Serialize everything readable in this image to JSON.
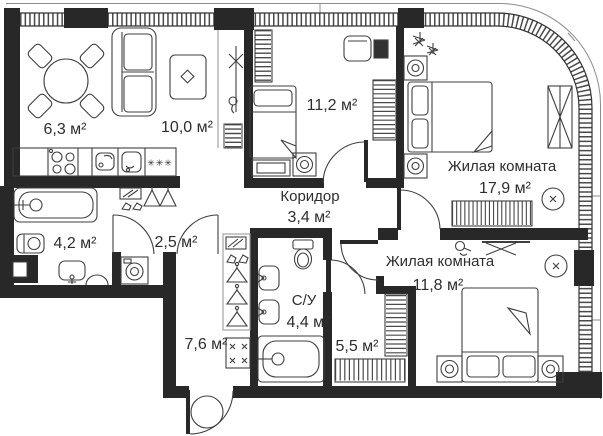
{
  "plan": {
    "type": "apartment-floor-plan",
    "unit_suffix": "м²",
    "rooms": [
      {
        "id": "dining-area",
        "area": "6,3 м²"
      },
      {
        "id": "living-area",
        "area": "10,0 м²"
      },
      {
        "id": "room-11-2",
        "area": "11,2 м²"
      },
      {
        "id": "bedroom-17-9",
        "name": "Жилая комната",
        "area": "17,9 м²"
      },
      {
        "id": "corridor",
        "name": "Коридор",
        "area": "3,4 м²"
      },
      {
        "id": "bathroom",
        "area": "4,2 м²"
      },
      {
        "id": "storage",
        "area": "2,5 м²"
      },
      {
        "id": "bedroom-11-8",
        "name": "Жилая комната",
        "area": "11,8 м²"
      },
      {
        "id": "wc",
        "name": "С/У",
        "area": "4,4 м²"
      },
      {
        "id": "wardrobe-5-5",
        "area": "5,5 м²"
      },
      {
        "id": "hallway",
        "area": "7,6 м²"
      }
    ],
    "symbols": {
      "freezer": "✳✳✳"
    },
    "colors": {
      "wall": "#282828",
      "line": "#3f3f3f",
      "glazing": "#4a4a4a",
      "facade": "#8c8c8c",
      "text": "#2e2e2e",
      "bg": "#ffffff"
    }
  }
}
